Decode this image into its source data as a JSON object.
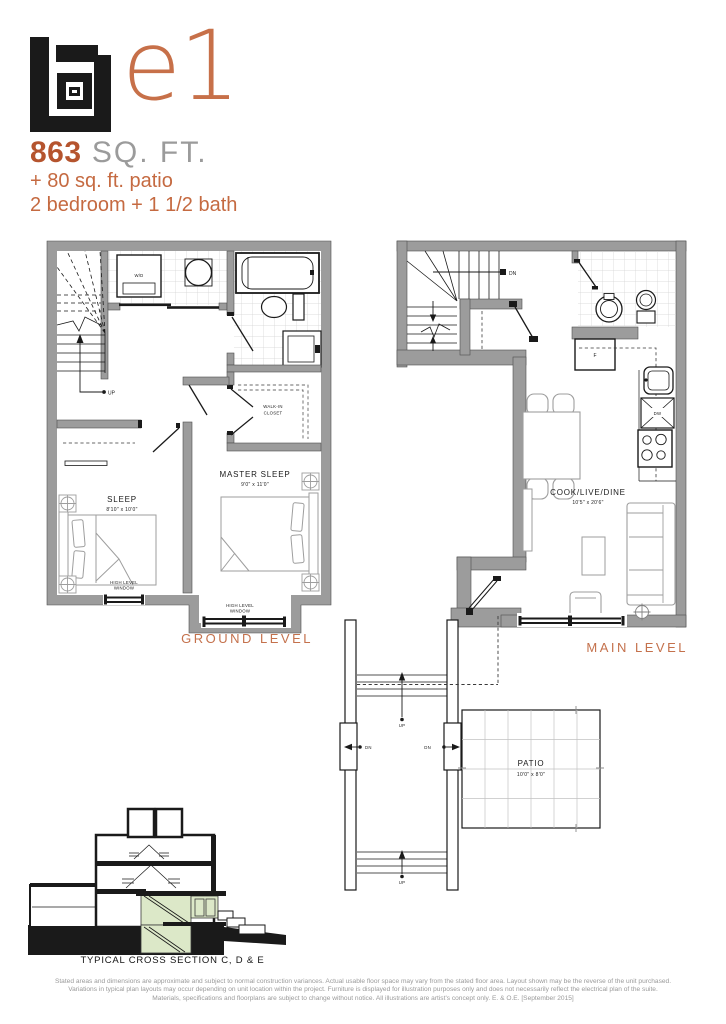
{
  "header": {
    "unit_name": "e1",
    "area_value": "863",
    "area_unit": " SQ. FT.",
    "patio_line": "+ 80 sq. ft. patio",
    "config_line": "2 bedroom + 1 1/2 bath"
  },
  "colors": {
    "accent": "#c56a41",
    "accent_strong": "#b5542e",
    "wall_gray": "#9c9c9c",
    "section_green": "#dce8c8"
  },
  "ground_level": {
    "label": "GROUND LEVEL",
    "wd_label": "W/D",
    "up_label": "UP",
    "closet_line1": "WALK-IN",
    "closet_line2": "CLOSET",
    "sleep_name": "SLEEP",
    "sleep_dims": "8'10\" x 10'0\"",
    "master_name": "MASTER SLEEP",
    "master_dims": "9'0\" x 11'0\"",
    "window_line1": "HIGH LEVEL",
    "window_line2": "WINDOW"
  },
  "main_level": {
    "label": "MAIN LEVEL",
    "dn_label": "DN",
    "fridge_label": "F",
    "dw_label": "DW",
    "room_name": "COOK/LIVE/DINE",
    "room_dims": "10'5\" x 20'6\""
  },
  "exterior": {
    "up_label": "UP",
    "dn_label": "DN",
    "patio_name": "PATIO",
    "patio_dims": "10'0\" x 8'0\""
  },
  "cross_section": {
    "label": "TYPICAL CROSS SECTION C, D & E"
  },
  "disclaimer": {
    "line1": "Stated areas and dimensions are approximate and subject to normal construction variances. Actual usable floor space may vary from the stated floor area. Layout shown may be the reverse of the unit purchased.",
    "line2": "Variations in typical plan layouts may occur depending on unit location within the project.  Furniture is displayed for illustration purposes only and does not necessarily reflect the electrical plan of the suite.",
    "line3": "Materials, specifications and floorplans are subject to change without notice. All illustrations are artist's concept only. E. & O.E. [September 2015]"
  }
}
